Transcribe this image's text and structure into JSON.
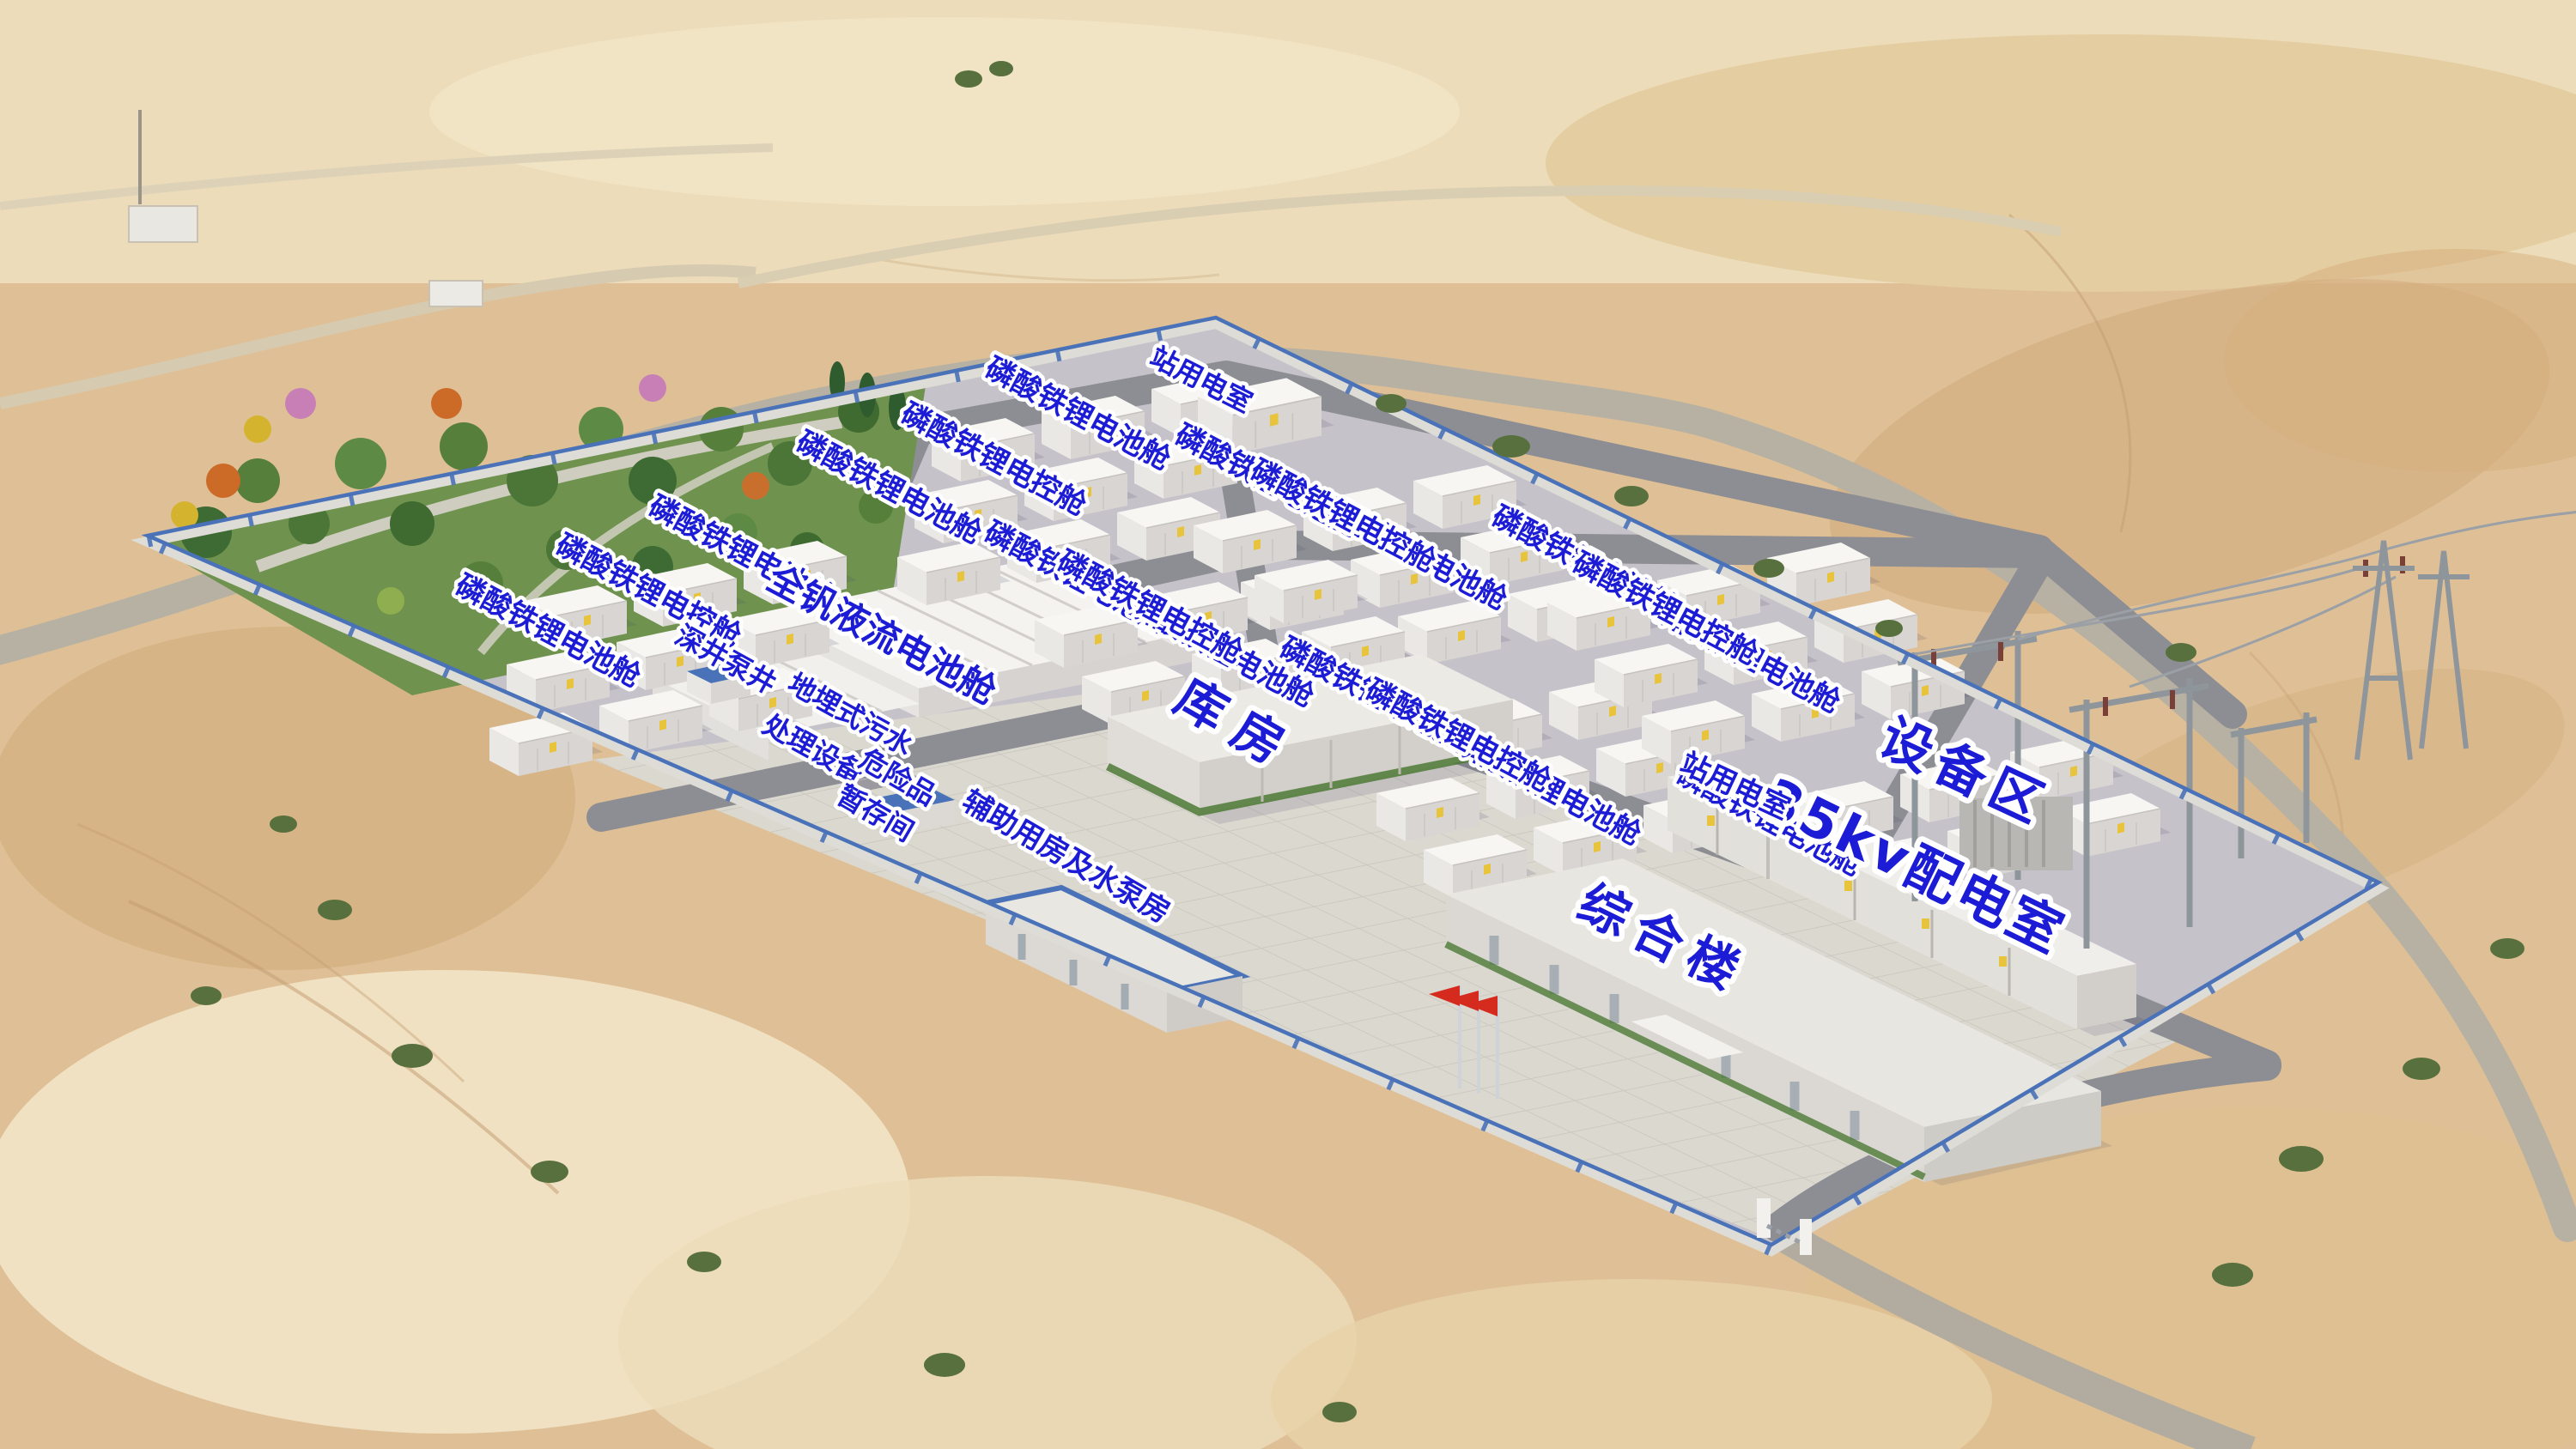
{
  "labels": {
    "battery_cabin": "磷酸铁锂电池舱",
    "control_cabin": "磷酸铁锂电控舱",
    "vanadium_cabin": "全钒液流电池舱",
    "station_power_room": "站用电室",
    "deep_well_pump": "深井泵井",
    "sewage_line1": "地埋式污水",
    "sewage_line2": "处理设备",
    "hazmat_line1": "危险品",
    "hazmat_line2": "暂存间",
    "auxiliary_house": "辅助用房及水泵房",
    "warehouse": "库房",
    "office_building": "综合楼",
    "equipment_area": "设备区",
    "kv35_room": "35kv配电室"
  },
  "colors": {
    "label_blue": "#1c1cd6",
    "label_outline": "#ffffff",
    "fence_blue": "#4a72b8",
    "flag_red": "#d42b1e",
    "sand": "#e0c49c",
    "gravel": "#c6c2ca",
    "plaza_concrete": "#dbd8d0",
    "road_gray": "#8d8e93",
    "cabin_white": "#f7f6f3",
    "tree_green": "#567f3c"
  }
}
